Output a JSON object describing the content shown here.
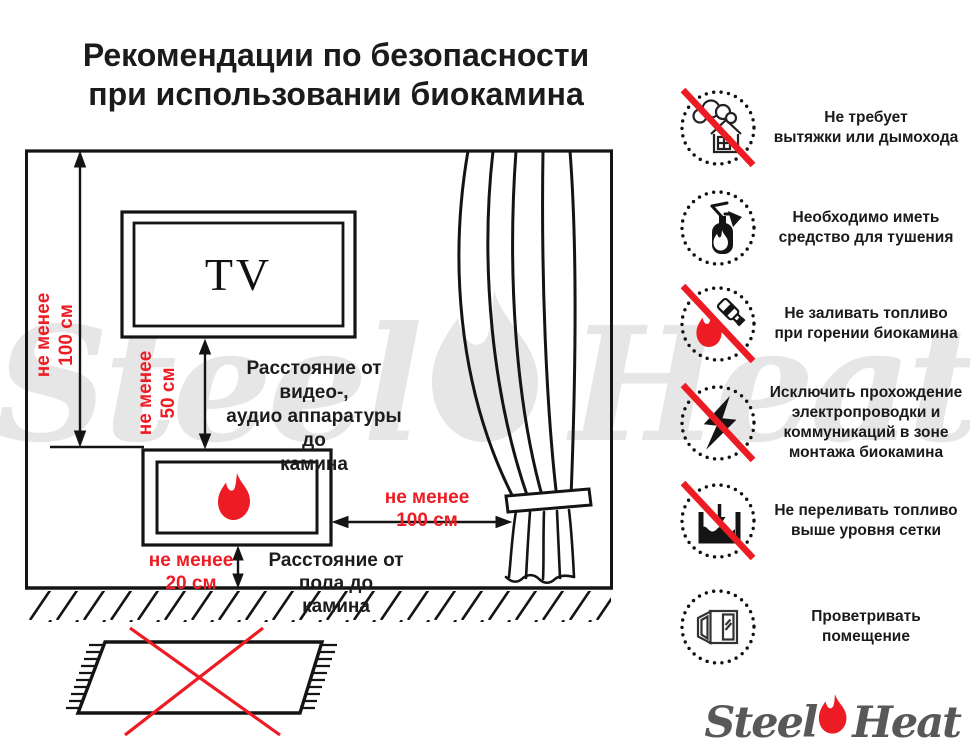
{
  "title": {
    "line1": "Рекомендации по безопасности",
    "line2": "при использовании биокамина"
  },
  "diagram": {
    "tv_label": "TV",
    "dims": {
      "wall_to_fireplace": [
        "не менее",
        "100 см"
      ],
      "tv_to_fireplace": [
        "не менее",
        "50 см"
      ],
      "fireplace_to_curtain": [
        "не менее",
        "100 см"
      ],
      "floor_to_fireplace": [
        "не менее",
        "20 см"
      ]
    },
    "labels": {
      "av": [
        "Расстояние от видео-,",
        "аудио аппаратуры до",
        "камина"
      ],
      "floor": [
        "Расстояние от пола до",
        "камина"
      ]
    }
  },
  "rules": [
    {
      "icon": "no-chimney-icon",
      "crossed": true,
      "lines": [
        "Не требует",
        "вытяжки или дымохода"
      ]
    },
    {
      "icon": "extinguisher-icon",
      "crossed": false,
      "lines": [
        "Необходимо иметь",
        "средство для тушения"
      ]
    },
    {
      "icon": "no-refuel-while-burning-icon",
      "crossed": true,
      "lines": [
        "Не заливать топливо",
        "при горении биокамина"
      ]
    },
    {
      "icon": "no-wiring-icon",
      "crossed": true,
      "lines": [
        "Исключить прохождение",
        "электропроводки и",
        "коммуникаций в зоне",
        "монтажа биокамина"
      ]
    },
    {
      "icon": "max-fuel-level-icon",
      "crossed": true,
      "lines": [
        "Не переливать топливо",
        "выше уровня сетки"
      ]
    },
    {
      "icon": "ventilate-window-icon",
      "crossed": false,
      "lines": [
        "Проветривать",
        "помещение"
      ]
    }
  ],
  "watermark": {
    "steel": "Steel",
    "heat": "Heat"
  },
  "logo": {
    "steel": "Steel",
    "heat": "Heat"
  },
  "colors": {
    "accent_red": "#ed1c24",
    "line_black": "#141414",
    "watermark_gray": "#e6e6e6",
    "logo_gray": "#58585a"
  }
}
